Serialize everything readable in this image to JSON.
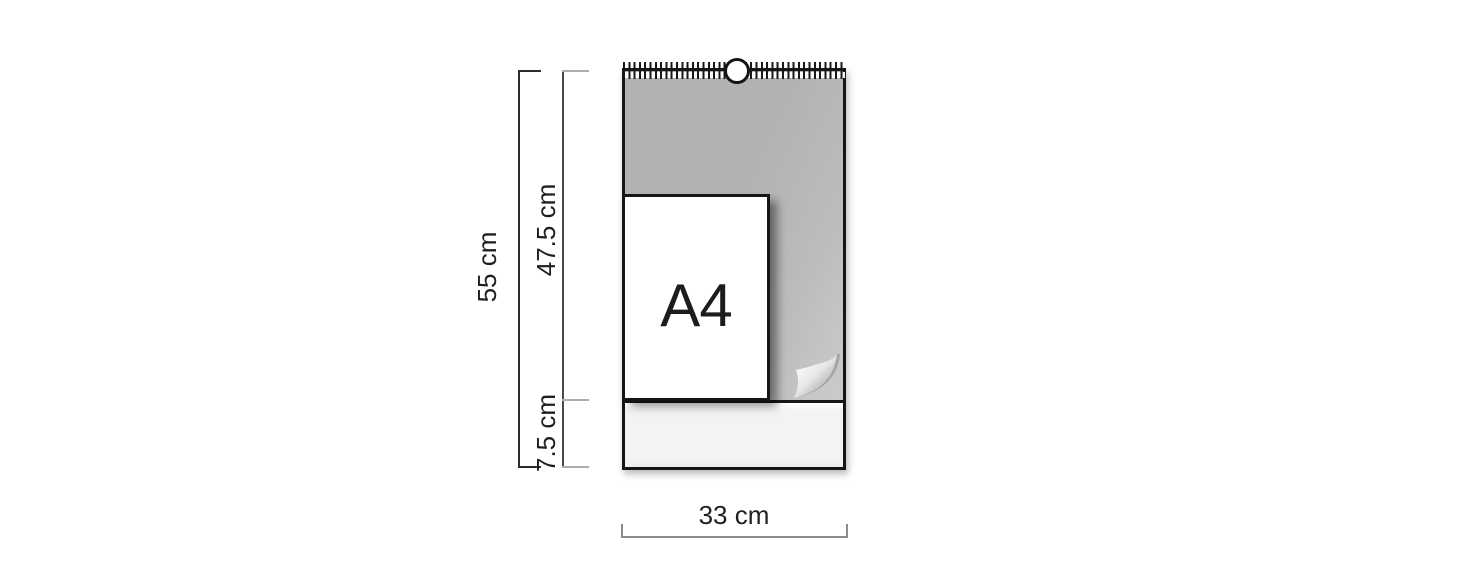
{
  "calendar": {
    "sheet_label": "A4"
  },
  "dimensions": {
    "total_height": "55 cm",
    "sheet_height": "47.5 cm",
    "footer_height": "7.5 cm",
    "width": "33 cm"
  },
  "icons": {
    "wire_binding": "wire-binding-icon",
    "hanging_ring": "hanging-ring-icon",
    "page_curl": "page-curl-icon"
  },
  "colors": {
    "outline": "#161616",
    "sheet_gray": "#b5b5b5",
    "sheet_gray_light": "#c9c9c9",
    "footer_bg": "#f3f3f3",
    "dim_dark": "#2d2d2d",
    "dim_light": "#aeaeae",
    "dim_mid": "#8c8c8c",
    "text": "#1e1e1e"
  }
}
